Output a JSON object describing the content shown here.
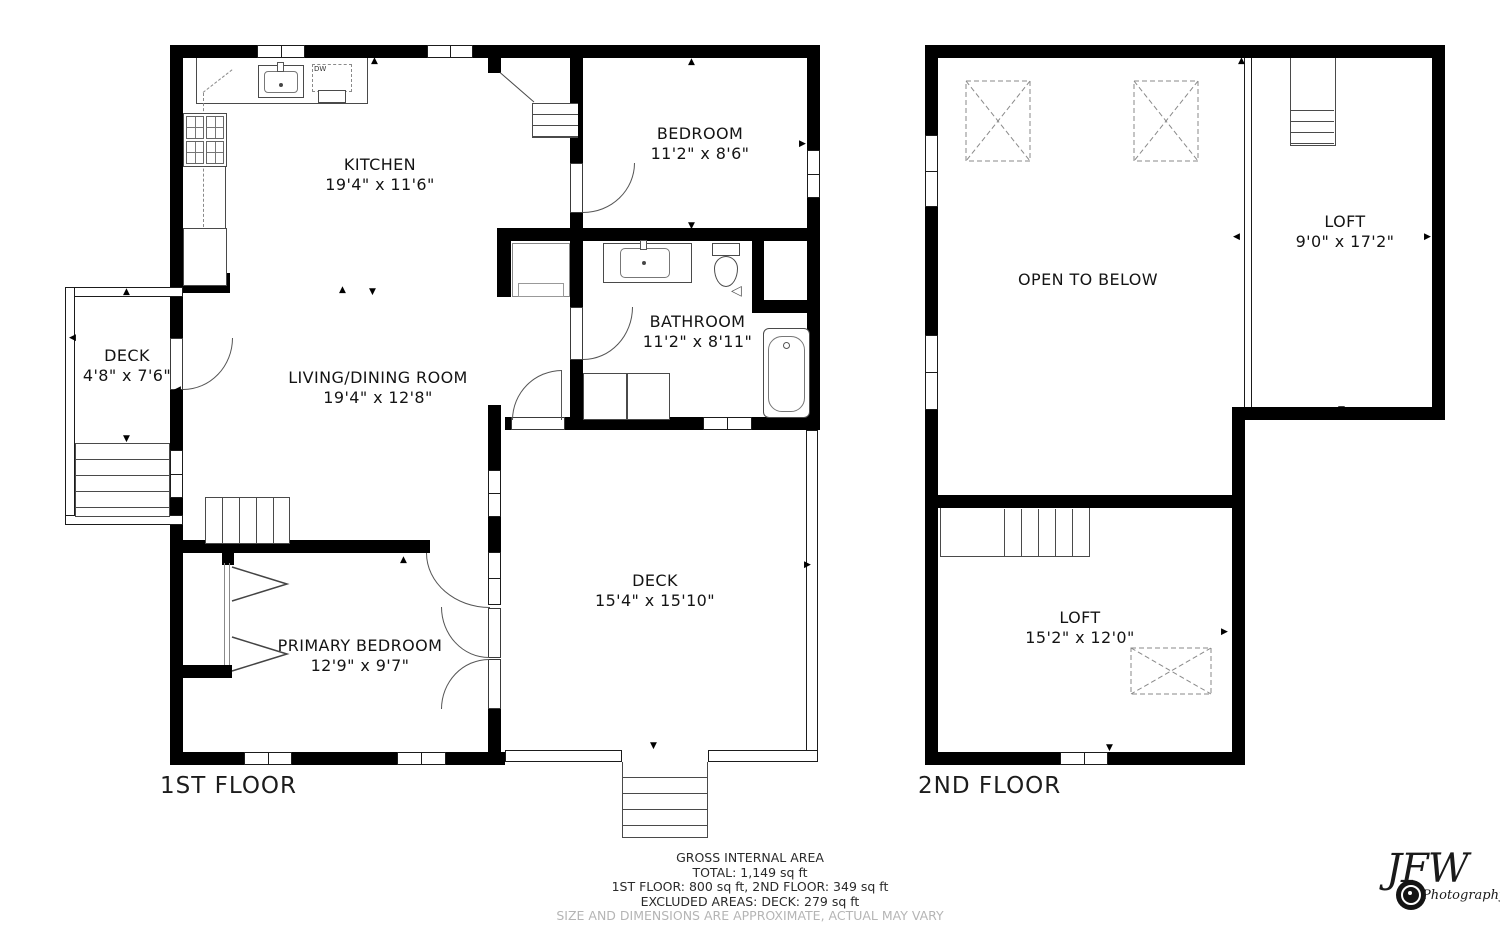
{
  "floors": {
    "first": {
      "title": "1ST FLOOR",
      "rooms": {
        "kitchen": {
          "name": "KITCHEN",
          "dims": "19'4\" x 11'6\""
        },
        "bedroom": {
          "name": "BEDROOM",
          "dims": "11'2\" x 8'6\""
        },
        "bathroom": {
          "name": "BATHROOM",
          "dims": "11'2\" x 8'11\""
        },
        "living": {
          "name": "LIVING/DINING ROOM",
          "dims": "19'4\" x 12'8\""
        },
        "primary": {
          "name": "PRIMARY BEDROOM",
          "dims": "12'9\" x 9'7\""
        },
        "deck_side": {
          "name": "DECK",
          "dims": "4'8\" x 7'6\""
        },
        "deck_rear": {
          "name": "DECK",
          "dims": "15'4\" x 15'10\""
        }
      },
      "appliances": {
        "dishwasher": "DW"
      }
    },
    "second": {
      "title": "2ND FLOOR",
      "rooms": {
        "open_to_below": {
          "name": "OPEN TO BELOW",
          "dims": ""
        },
        "loft_upper": {
          "name": "LOFT",
          "dims": "9'0\" x 17'2\""
        },
        "loft_lower": {
          "name": "LOFT",
          "dims": "15'2\" x 12'0\""
        }
      }
    }
  },
  "footer": {
    "line1": "GROSS INTERNAL AREA",
    "line2": "TOTAL: 1,149 sq ft",
    "line3": "1ST FLOOR: 800 sq ft, 2ND FLOOR: 349 sq ft",
    "line4": "EXCLUDED AREAS: DECK: 279 sq ft",
    "line5": "SIZE AND DIMENSIONS ARE APPROXIMATE, ACTUAL MAY VARY"
  },
  "logo": {
    "initials": "JFW",
    "word": "Photography"
  },
  "icons": {
    "arrow_up": "▲",
    "arrow_down": "▼",
    "arrow_left": "◀",
    "arrow_right": "▶",
    "fixture_triangle": "◁"
  },
  "colors": {
    "wall": "#000000",
    "fixture_line": "#4a4a4a",
    "disclaimer": "#b5b5b5"
  }
}
